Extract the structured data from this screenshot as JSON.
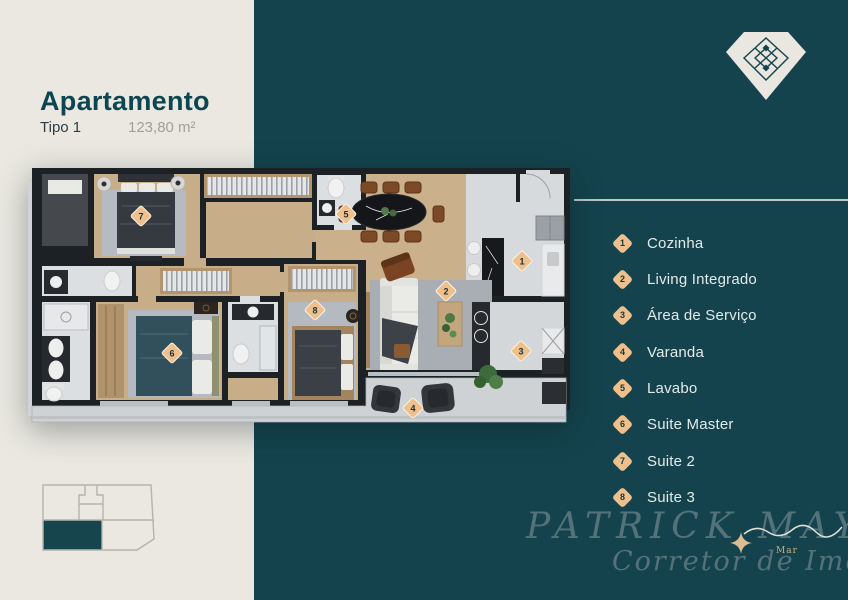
{
  "header": {
    "title": "Apartamento",
    "type": "Tipo 1",
    "area": "123,80 m²"
  },
  "legend": {
    "items": [
      {
        "number": "1",
        "label": "Cozinha"
      },
      {
        "number": "2",
        "label": "Living Integrado"
      },
      {
        "number": "3",
        "label": "Área de Serviço"
      },
      {
        "number": "4",
        "label": "Varanda"
      },
      {
        "number": "5",
        "label": "Lavabo"
      },
      {
        "number": "6",
        "label": "Suite Master"
      },
      {
        "number": "7",
        "label": "Suite 2"
      },
      {
        "number": "8",
        "label": "Suite 3"
      }
    ]
  },
  "watermark": {
    "name": "PATRICK MAYA",
    "role": "Corretor de Imóveis",
    "tag": "Mar"
  },
  "colors": {
    "background_cream": "#eae8e1",
    "panel_teal": "#14434d",
    "title_teal": "#0c4650",
    "marker_tan": "#efc08c",
    "legend_text": "#e3eaea",
    "watermark_gray": "#7c8f96",
    "gold": "#dcbd8f"
  },
  "icons": {
    "brand": "diamond-gem-icon",
    "sparkle": "four-point-star-icon",
    "wave": "sea-wave-icon"
  }
}
